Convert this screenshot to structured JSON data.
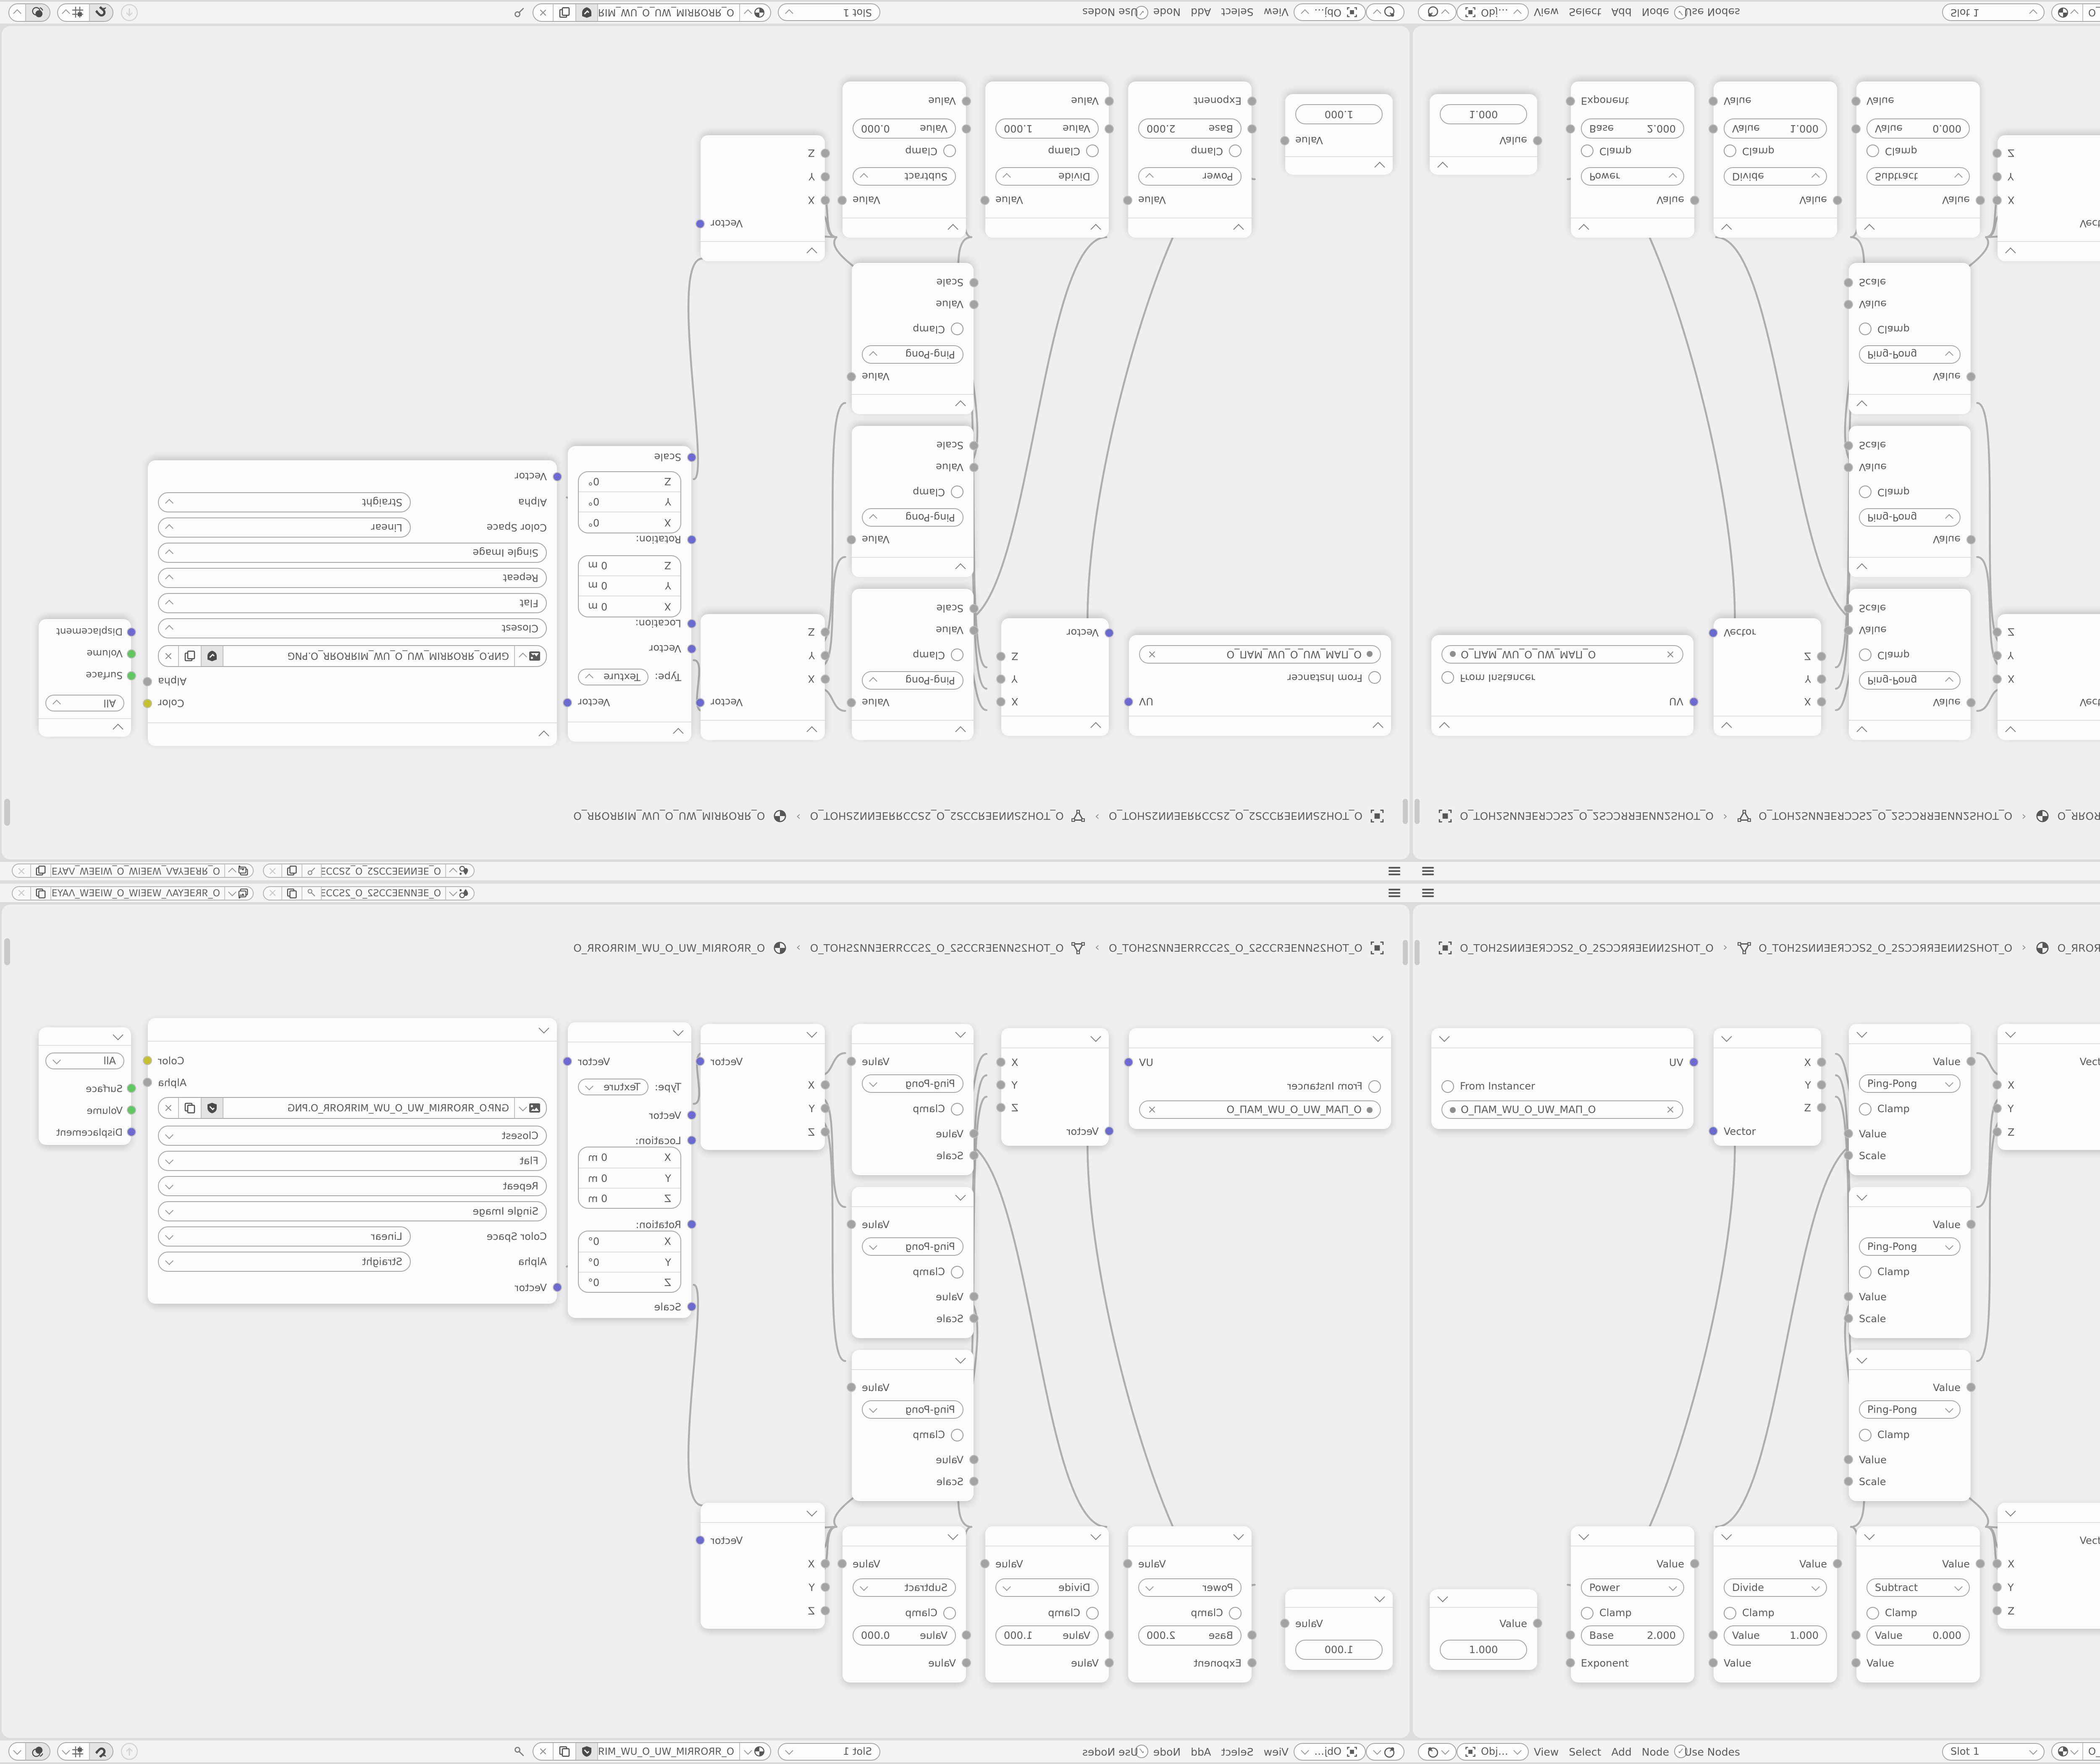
{
  "icons": {
    "close": "×",
    "check": "✓"
  },
  "colors": {
    "accent_purple": "#6a6ad1",
    "socket_gray": "#a3a3a3",
    "socket_green": "#5ec85e",
    "socket_yellow": "#c2c22f",
    "bar_bg": "#f3f3f3",
    "viewport_bg": "#efefef",
    "node_bg": "#fcfcfc"
  },
  "topbar": {
    "scene_name": "O_ƎEИИƎEƆƆЅ2_O_2ЅƆƆƎИ…",
    "view_layer_name": "O_ЯRƎEYAΛ_WƎEIW_O_WIƎEW_ΛAYƎEЯR_O"
  },
  "breadcrumb": {
    "separator": "›",
    "object_name": "O_TOH2SИИƎEЯƆƆS2_O_2SƆƆЯЯƎEИИ2SHOT_O",
    "mesh_name": "O_TOH2SИИƎEЯƆƆS2_O_2SƆƆЯЯƎEИИ2SHOT_O",
    "material_name": "O_ЯROЯRIM_WU_O_UW_MIЯROЯR_O"
  },
  "header": {
    "shader_type": "Object",
    "menus": [
      "View",
      "Select",
      "Add",
      "Node"
    ],
    "use_nodes_label": "Use Nodes",
    "slot_label": "Slot 1",
    "material_name": "O_ЯROЯRIM_WU_O_UW_MIЯROЯR_O"
  },
  "nodes": {
    "uv_map": {
      "output": "UV",
      "from_instancer_label": "From Instancer",
      "uv_name": "O_ΠAM_WU_O_UW_MAΠ_O"
    },
    "separate_xyz": {
      "outputs": [
        "X",
        "Y",
        "Z"
      ],
      "input": "Vector"
    },
    "math_pingpong": {
      "output": "Value",
      "operation": "Ping-Pong",
      "clamp_label": "Clamp",
      "value_input": "Value",
      "scale_input": "Scale"
    },
    "combine_xyz": {
      "output": "Vector",
      "inputs": [
        "X",
        "Y",
        "Z"
      ]
    },
    "mapping": {
      "output": "Vector",
      "type_label": "Type:",
      "type_value": "Texture",
      "vector_input": "Vector",
      "location_label": "Location:",
      "location_rows": [
        {
          "axis": "X",
          "value": "0 m"
        },
        {
          "axis": "Y",
          "value": "0 m"
        },
        {
          "axis": "Z",
          "value": "0 m"
        }
      ],
      "rotation_label": "Rotation:",
      "rotation_rows": [
        {
          "axis": "X",
          "value": "0°"
        },
        {
          "axis": "Y",
          "value": "0°"
        },
        {
          "axis": "Z",
          "value": "0°"
        }
      ],
      "scale_input": "Scale"
    },
    "image_texture": {
      "color_output": "Color",
      "alpha_output": "Alpha",
      "filename": "GИP.O_ЯROЯRIM_WU_O_UW_MIЯROЯR_O.PNG",
      "interpolation": "Closest",
      "projection": "Flat",
      "extension": "Repeat",
      "source": "Single Image",
      "color_space_label": "Color Space",
      "color_space_value": "Linear",
      "alpha_label": "Alpha",
      "alpha_value": "Straight",
      "vector_input": "Vector"
    },
    "material_output": {
      "target": "All",
      "inputs": [
        "Surface",
        "Volume",
        "Displacement"
      ]
    },
    "value": {
      "output": "Value",
      "value": "1.000"
    },
    "math_power": {
      "output": "Value",
      "operation": "Power",
      "clamp_label": "Clamp",
      "field_label": "Base",
      "field_value": "2.000",
      "input": "Exponent"
    },
    "math_divide": {
      "output": "Value",
      "operation": "Divide",
      "clamp_label": "Clamp",
      "field_label": "Value",
      "field_value": "1.000",
      "input": "Value"
    },
    "math_subtract": {
      "output": "Value",
      "operation": "Subtract",
      "clamp_label": "Clamp",
      "field_label": "Value",
      "field_value": "0.000",
      "input": "Value"
    }
  }
}
